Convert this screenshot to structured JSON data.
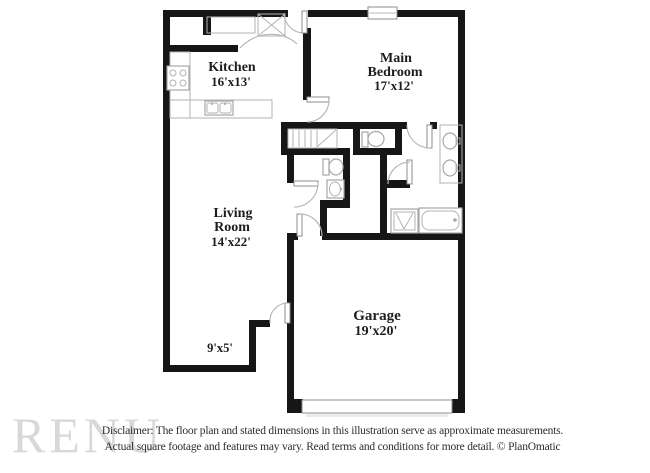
{
  "plan": {
    "rooms": {
      "kitchen": {
        "name": "Kitchen",
        "dims": "16'x13'"
      },
      "main_bedroom": {
        "line1": "Main",
        "line2": "Bedroom",
        "dims": "17'x12'"
      },
      "living_room": {
        "line1": "Living",
        "line2": "Room",
        "dims": "14'x22'"
      },
      "garage": {
        "name": "Garage",
        "dims": "19'x20'"
      },
      "nook": {
        "dims": "9'x5'"
      }
    }
  },
  "watermark": "RENU",
  "footer": {
    "line1": "Disclaimer: The floor plan and stated dimensions in this illustration serve as approximate measurements.",
    "line2": "Actual square footage and features may vary. Read terms and conditions for more detail. © PlanOmatic"
  },
  "colors": {
    "wall": "#161616",
    "fixture_stroke": "#a6a6a6",
    "door_arc": "#b3b3b3",
    "label_text": "#1d1d1d",
    "watermark_text": "#d8d8d8",
    "footer_text": "#2d2d2d"
  }
}
